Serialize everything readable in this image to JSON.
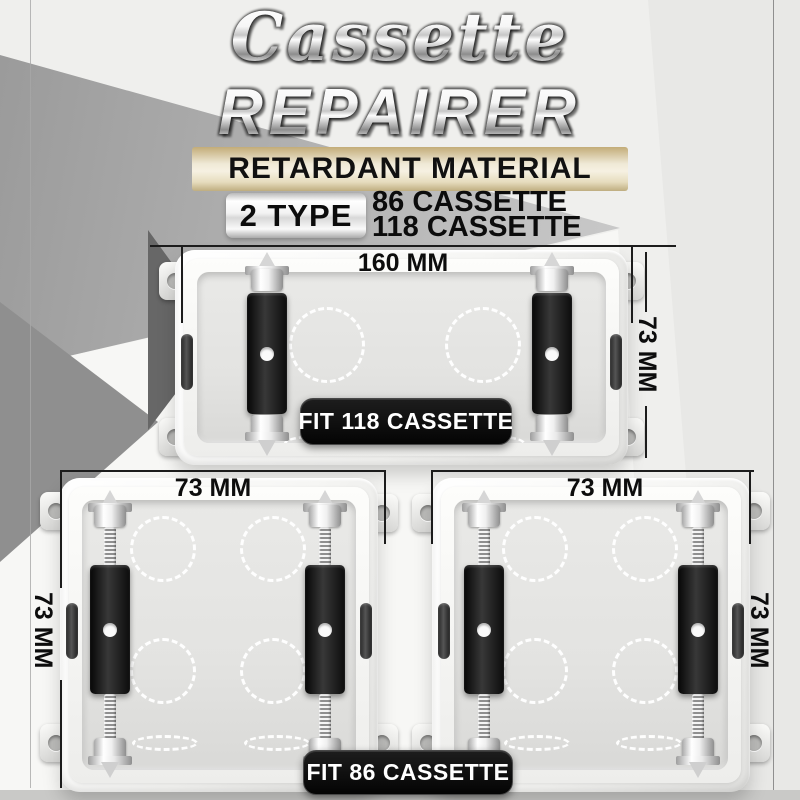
{
  "title": {
    "script": "Cassette",
    "main": "REPAIRER",
    "banner": "RETARDANT MATERIAL"
  },
  "type_selector": {
    "badge": "2 TYPE",
    "options": [
      "86 CASSETTE",
      "118 CASSETTE"
    ]
  },
  "cassette_118": {
    "width_label": "160 MM",
    "height_label": "73 MM",
    "fit_label": "FIT 118 CASSETTE"
  },
  "cassette_86_left": {
    "width_label": "73 MM",
    "height_label": "73 MM"
  },
  "cassette_86_right": {
    "width_label": "73 MM",
    "height_label": "73 MM"
  },
  "fit_86_label": "FIT 86 CASSETTE",
  "colors": {
    "banner_gold": "#cdbc90",
    "pill_black": "#0b0b0b",
    "bracket_black": "#1a1a1a",
    "metal_silver": "#d9d9d9",
    "dim_line": "#1c1c1c"
  }
}
